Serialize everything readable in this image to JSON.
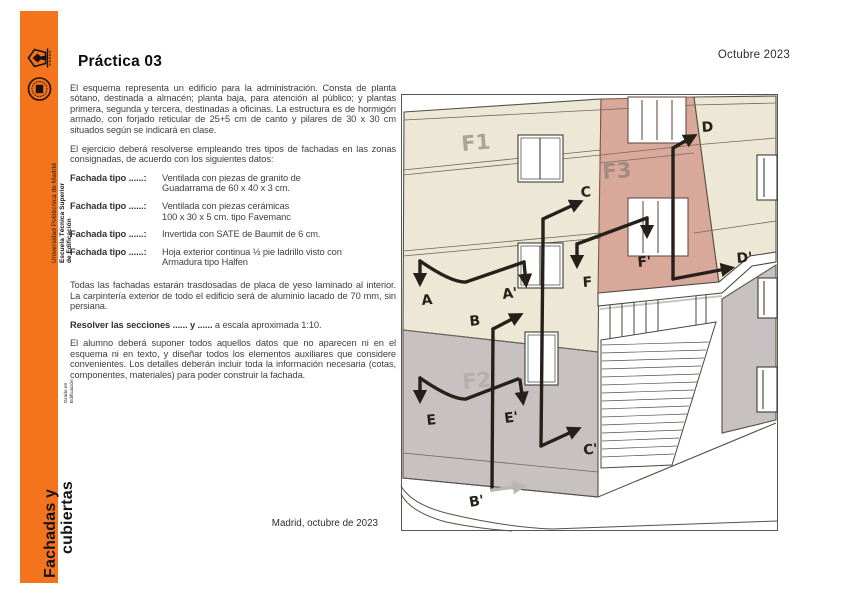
{
  "page": {
    "date_top": "Octubre 2023",
    "date_bottom": "Madrid, octubre de 2023"
  },
  "sidebar": {
    "accent_color": "#F4731D",
    "university": "Universidad Politécnica de Madrid",
    "school_line1": "Escuela Técnica Superior",
    "school_line2": "de Edificación",
    "course_title_line1": "Fachadas y",
    "course_title_line2": "cubiertas",
    "degree_line1": "Grado en",
    "degree_line2": "Edificación",
    "icons": [
      "upm-crest-icon",
      "school-seal-icon"
    ]
  },
  "main": {
    "title": "Práctica 03",
    "paragraph1": "El esquema representa un edificio para la administración. Consta de planta sótano, destinada a almacén; planta baja, para atención al público; y plantas primera, segunda y tercera, destinadas a oficinas. La estructura es de hormigón armado, con forjado reticular de 25+5 cm de canto y pilares de 30 x 30 cm situados según se indicará en clase.",
    "paragraph2": "El ejercicio deberá resolverse empleando tres tipos de fachadas en las zonas consignadas, de acuerdo con los siguientes datos:",
    "fachadas": [
      {
        "label": "Fachada tipo ......:",
        "description": "Ventilada con piezas de granito de\nGuadarrama de 60 x 40 x 3 cm."
      },
      {
        "label": "Fachada tipo ......:",
        "description": "Ventilada con piezas cerámicas\n100 x 30 x 5 cm. tipo Favemanc"
      },
      {
        "label": "Fachada tipo ......:",
        "description": "Invertida con SATE de Baumit de 6 cm."
      },
      {
        "label": "Fachada tipo ......:",
        "description": "Hoja exterior continua ½ pie ladrillo visto con\nArmadura tipo Halfen"
      }
    ],
    "paragraph3": "Todas las fachadas estarán trasdosadas de placa de yeso laminado al interior. La carpintería exterior de todo el edificio será de aluminio lacado de 70 mm, sin persiana.",
    "resolver_bold": "Resolver las secciones ...... y ......",
    "resolver_rest": " a escala aproximada 1:10.",
    "paragraph4": "El alumno deberá suponer todos aquellos datos que no aparecen ni en el esquema ni en texto, y diseñar todos los elementos auxiliares que considere convenientes. Los detalles deberán incluir toda la información necesaria (cotas, componentes, materiales) para poder construir la fachada."
  },
  "sketch": {
    "zone_labels": [
      "F1",
      "F2",
      "F3"
    ],
    "section_marks": [
      "A",
      "A'",
      "B",
      "B'",
      "C",
      "C'",
      "D",
      "D'",
      "E",
      "E'",
      "F",
      "F'"
    ],
    "colors": {
      "facade_cream": "#EDE7D6",
      "facade_pink": "#D8A89A",
      "facade_grey": "#C8C1C1",
      "ink": "#26201B",
      "grey_arrow": "#BBB6B1"
    }
  }
}
